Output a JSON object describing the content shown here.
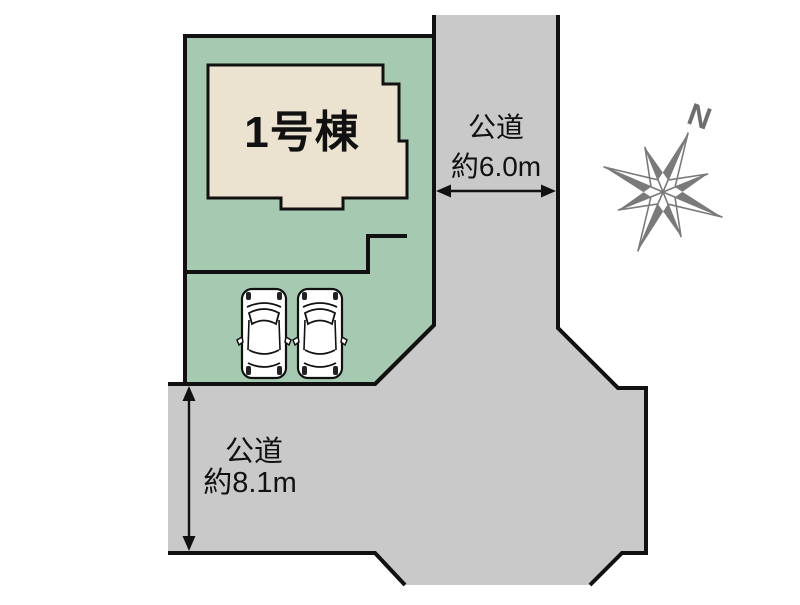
{
  "plot": {
    "building_label": "1号棟"
  },
  "east_road": {
    "name": "公道",
    "width": "約6.0m"
  },
  "south_road": {
    "name": "公道",
    "width": "約8.1m"
  },
  "compass": {
    "north_label": "N"
  },
  "cars": {
    "count": 2
  },
  "colors": {
    "plot_green": "#a5c9b1",
    "road_gray": "#c9c9c9",
    "building_cream": "#ebe3cf",
    "outline_black": "#111111",
    "compass_gray": "#7a7a7a",
    "background": "#ffffff"
  }
}
